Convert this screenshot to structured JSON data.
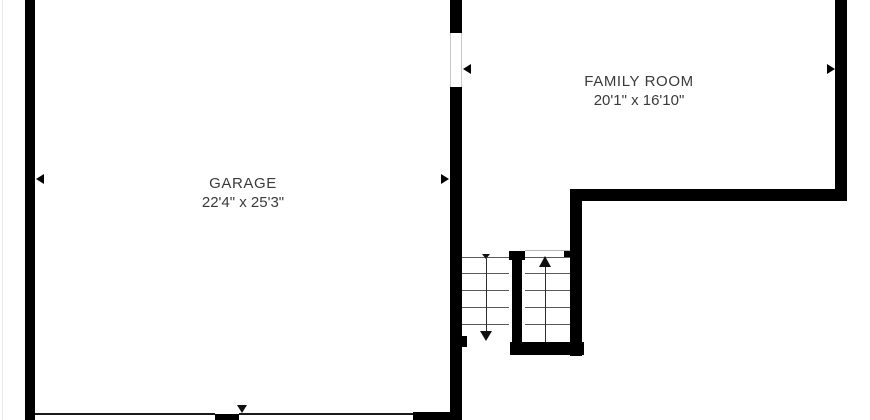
{
  "floorplan": {
    "title": "First floor plan (partial view: garage, family room, staircase)",
    "rooms": [
      {
        "name": "GARAGE",
        "dimensions": "22'4\" x 25'3\""
      },
      {
        "name": "FAMILY ROOM",
        "dimensions": "20'1\" x 16'10\""
      }
    ],
    "stairs": {
      "flights": 2,
      "down_flight_tread_lines": 5,
      "up_flight_tread_lines": 5,
      "direction_arrows": [
        "down",
        "up"
      ]
    },
    "openings": [
      {
        "between": "GARAGE and FAMILY ROOM",
        "type": "cased-opening"
      },
      {
        "at": "garage bottom wall",
        "type": "garage-door",
        "count": 2
      }
    ],
    "icons": [
      "stairs-down-arrow-icon",
      "stairs-up-arrow-icon",
      "dimension-arrow-left-icon",
      "dimension-arrow-right-icon",
      "dimension-arrow-down-icon"
    ],
    "colors": {
      "wall": "#000000",
      "background": "#ffffff",
      "label_text": "#3a3a3a",
      "tread_line": "#5a5a5a",
      "door_jamb_line": "#c9c9c9"
    }
  }
}
